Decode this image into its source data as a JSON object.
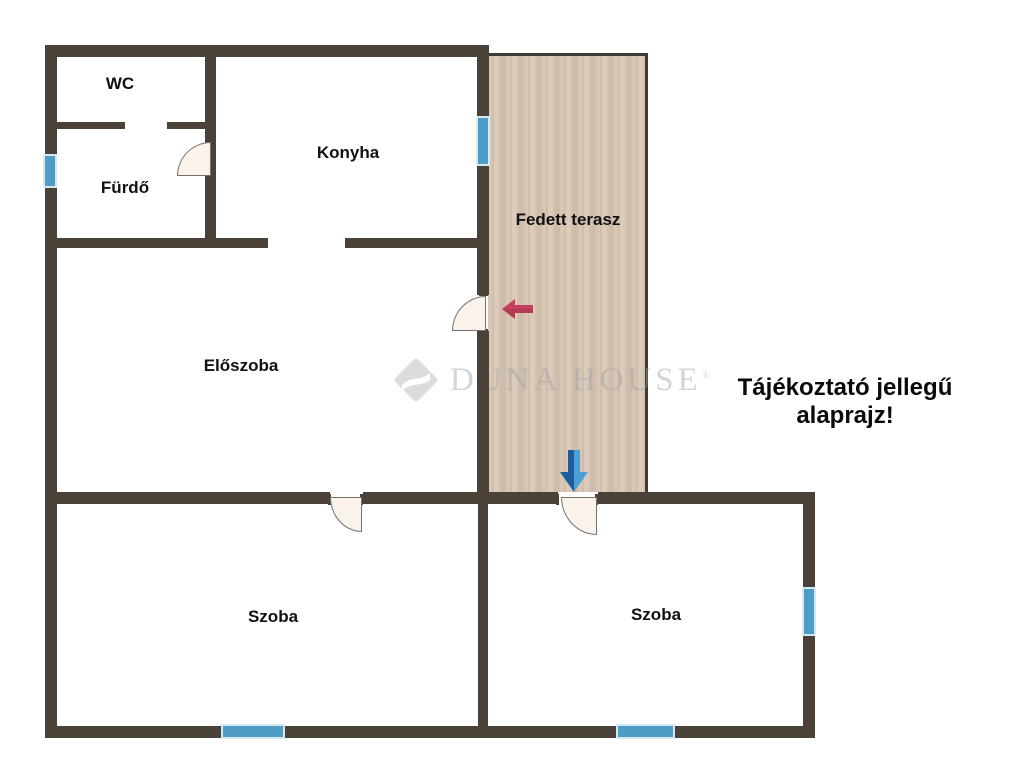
{
  "disclaimer": "Tájékoztató jellegű alaprajz!",
  "watermark": {
    "brand": "Duna House",
    "display": "DUNA HOUSE",
    "registered": "®"
  },
  "rooms": {
    "wc": "WC",
    "furdo": "Fürdő",
    "konyha": "Konyha",
    "terasz": "Fedett terasz",
    "eloszoba": "Előszoba",
    "szoba_left": "Szoba",
    "szoba_right": "Szoba"
  },
  "icons": {
    "red_arrow": "left-arrow",
    "blue_arrow": "down-arrow",
    "logo": "duna-house-diamond"
  },
  "colors": {
    "wall": "#4a4138",
    "window_fill": "#4f9dc7",
    "window_border": "#d6e9f3",
    "terrace_base": "#d5c3b2",
    "door_fill": "#faf3eb",
    "arrow_red": "#c4405c",
    "arrow_blue_dark": "#1d5d9e",
    "arrow_blue_light": "#4da0d6",
    "label": "#111111",
    "background": "#ffffff"
  }
}
